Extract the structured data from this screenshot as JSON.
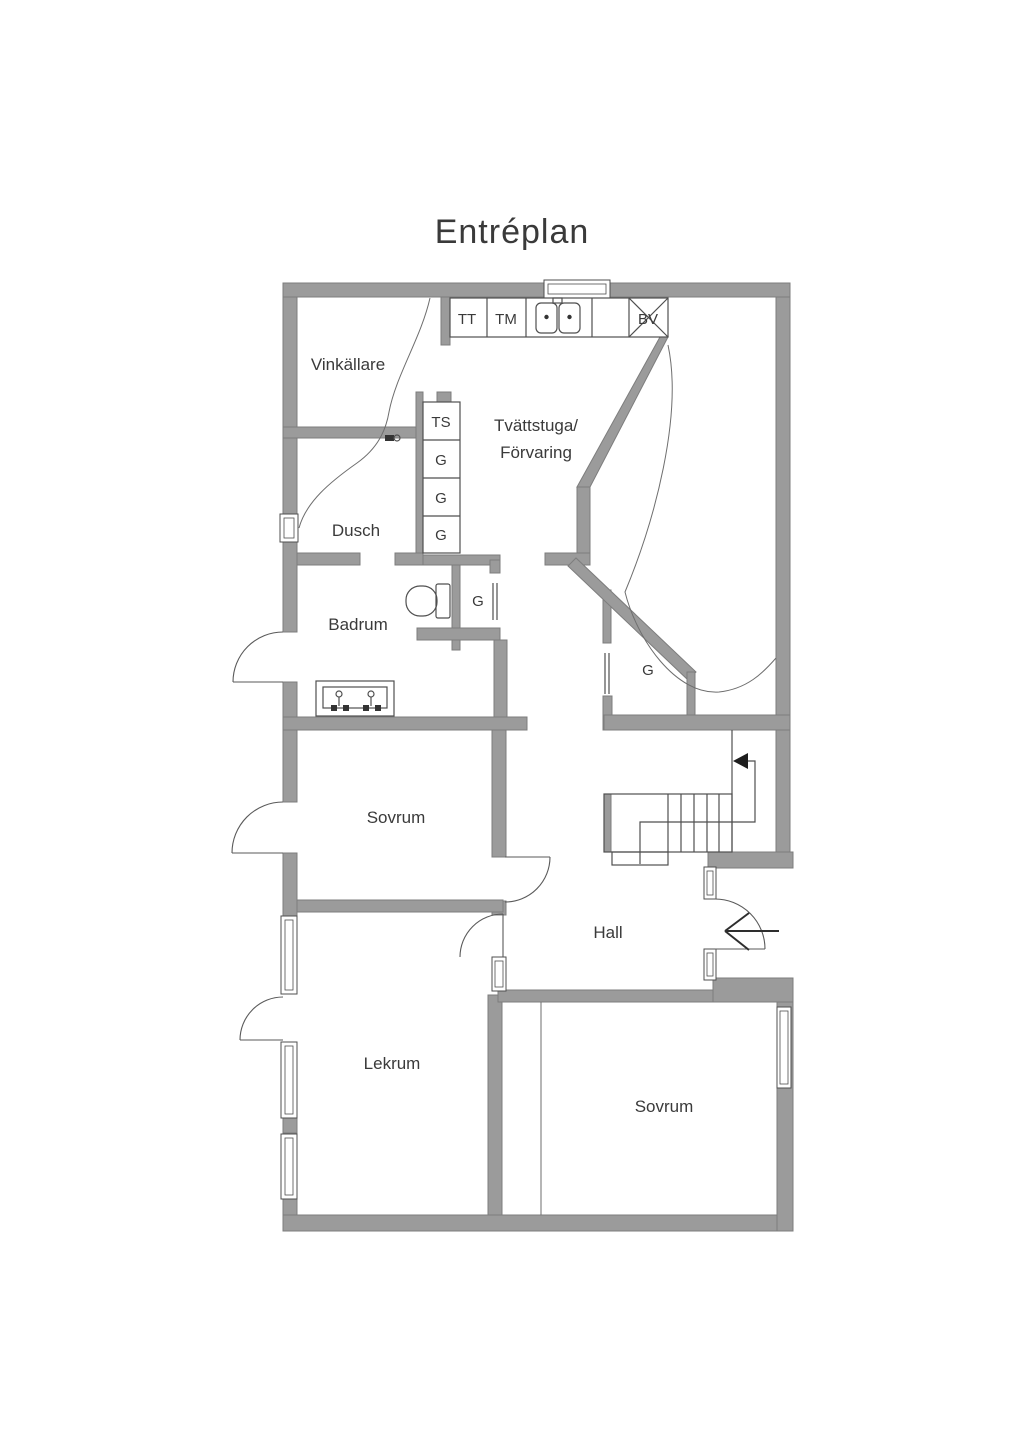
{
  "title": "Entréplan",
  "colors": {
    "wall": "#9b9b9b",
    "wall_edge": "#7d7d7d",
    "line": "#4f4f4f",
    "text": "#3a3a3a",
    "background": "#ffffff"
  },
  "labels": [
    {
      "id": "title",
      "text": "Entréplan",
      "x": 512,
      "y": 243,
      "cls": "title"
    },
    {
      "id": "room-vinkallare",
      "text": "Vinkällare",
      "x": 348,
      "y": 370,
      "cls": "room"
    },
    {
      "id": "room-tvattstuga-line1",
      "text": "Tvättstuga/",
      "x": 536,
      "y": 431,
      "cls": "room"
    },
    {
      "id": "room-tvattstuga-line2",
      "text": "Förvaring",
      "x": 536,
      "y": 458,
      "cls": "room"
    },
    {
      "id": "room-dusch",
      "text": "Dusch",
      "x": 356,
      "y": 536,
      "cls": "room"
    },
    {
      "id": "room-badrum",
      "text": "Badrum",
      "x": 358,
      "y": 630,
      "cls": "room"
    },
    {
      "id": "room-sovrum-upper",
      "text": "Sovrum",
      "x": 396,
      "y": 823,
      "cls": "room"
    },
    {
      "id": "room-hall",
      "text": "Hall",
      "x": 608,
      "y": 938,
      "cls": "room"
    },
    {
      "id": "room-lekrum",
      "text": "Lekrum",
      "x": 392,
      "y": 1069,
      "cls": "room"
    },
    {
      "id": "room-sovrum-lower",
      "text": "Sovrum",
      "x": 664,
      "y": 1112,
      "cls": "room"
    },
    {
      "id": "fixture-tt",
      "text": "TT",
      "x": 467,
      "y": 324,
      "cls": "small"
    },
    {
      "id": "fixture-tm",
      "text": "TM",
      "x": 506,
      "y": 324,
      "cls": "small"
    },
    {
      "id": "fixture-bv",
      "text": "BV",
      "x": 648,
      "y": 324,
      "cls": "small"
    },
    {
      "id": "cabinet-ts",
      "text": "TS",
      "x": 441,
      "y": 427,
      "cls": "small"
    },
    {
      "id": "cabinet-g1",
      "text": "G",
      "x": 441,
      "y": 465,
      "cls": "small"
    },
    {
      "id": "cabinet-g2",
      "text": "G",
      "x": 441,
      "y": 503,
      "cls": "small"
    },
    {
      "id": "cabinet-g3",
      "text": "G",
      "x": 441,
      "y": 540,
      "cls": "small"
    },
    {
      "id": "closet-g4",
      "text": "G",
      "x": 478,
      "y": 606,
      "cls": "small"
    },
    {
      "id": "closet-g5",
      "text": "G",
      "x": 648,
      "y": 675,
      "cls": "small"
    }
  ]
}
